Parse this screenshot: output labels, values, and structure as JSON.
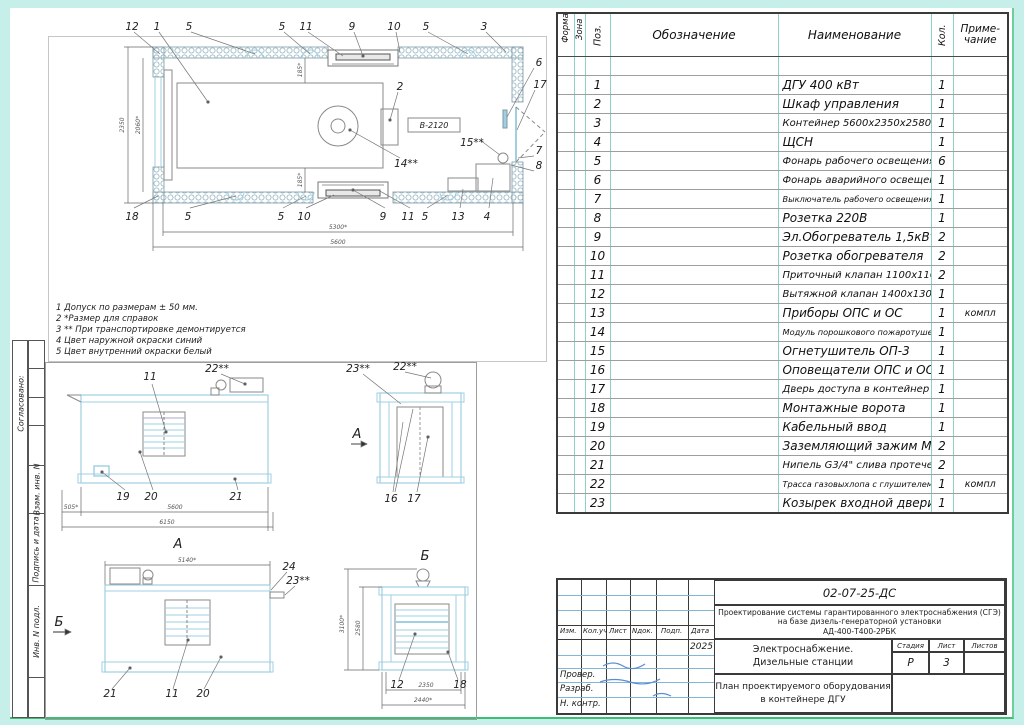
{
  "colors": {
    "sheet_margin": "#c7efe9",
    "drawing_blue": "#9fcfe0",
    "table_teal": "#8fd0c4",
    "signature_blue": "#5b8dd6",
    "frame_green": "#3fbd74"
  },
  "sidebar": {
    "soglasovano": "Согласовано:",
    "vzam": "Взам. инв. N",
    "podpis": "Подпись и дата",
    "inv": "Инв. N подл."
  },
  "notes": [
    "1 Допуск по размерам ± 50 мм.",
    "2 *Размер для справок",
    "3 ** При транспортировке демонтируется",
    "4 Цвет наружной окраски синий",
    "5 Цвет внутренний окраски белый"
  ],
  "spec": {
    "headers": {
      "format": "Формат",
      "zona": "Зона",
      "poz": "Поз.",
      "oboz": "Обозначение",
      "name": "Наименование",
      "kol": "Кол.",
      "prim1": "Приме-",
      "prim2": "чание"
    },
    "rows": [
      {
        "poz": "1",
        "name": "ДГУ 400 кВт",
        "qty": "1",
        "note": ""
      },
      {
        "poz": "2",
        "name": "Шкаф управления",
        "qty": "1",
        "note": ""
      },
      {
        "poz": "3",
        "name": "Контейнер 5600х2350х2580",
        "qty": "1",
        "note": ""
      },
      {
        "poz": "4",
        "name": "ЩСН",
        "qty": "1",
        "note": ""
      },
      {
        "poz": "5",
        "name": "Фонарь рабочего освещения",
        "qty": "6",
        "note": ""
      },
      {
        "poz": "6",
        "name": "Фонарь аварийного освещения",
        "qty": "1",
        "note": ""
      },
      {
        "poz": "7",
        "name": "Выключатель рабочего освещения",
        "qty": "1",
        "note": ""
      },
      {
        "poz": "8",
        "name": "Розетка 220В",
        "qty": "1",
        "note": ""
      },
      {
        "poz": "9",
        "name": "Эл.Обогреватель 1,5кВт",
        "qty": "2",
        "note": ""
      },
      {
        "poz": "10",
        "name": "Розетка обогревателя",
        "qty": "2",
        "note": ""
      },
      {
        "poz": "11",
        "name": "Приточный клапан 1100х1100",
        "qty": "2",
        "note": ""
      },
      {
        "poz": "12",
        "name": "Вытяжной клапан 1400х1300",
        "qty": "1",
        "note": ""
      },
      {
        "poz": "13",
        "name": "Приборы ОПС и ОС",
        "qty": "1",
        "note": "компл"
      },
      {
        "poz": "14",
        "name": "Модуль порошкового пожаротушения",
        "qty": "1",
        "note": ""
      },
      {
        "poz": "15",
        "name": "Огнетушитель ОП-3",
        "qty": "1",
        "note": ""
      },
      {
        "poz": "16",
        "name": "Оповещатели ОПС и ОС",
        "qty": "1",
        "note": ""
      },
      {
        "poz": "17",
        "name": "Дверь доступа в контейнер",
        "qty": "1",
        "note": ""
      },
      {
        "poz": "18",
        "name": "Монтажные ворота",
        "qty": "1",
        "note": ""
      },
      {
        "poz": "19",
        "name": "Кабельный ввод",
        "qty": "1",
        "note": ""
      },
      {
        "poz": "20",
        "name": "Заземляющий зажим М16",
        "qty": "2",
        "note": ""
      },
      {
        "poz": "21",
        "name": "Нипель G3/4\" слива протечек",
        "qty": "2",
        "note": ""
      },
      {
        "poz": "22",
        "name": "Трасса газовыхлопа с глушителем",
        "qty": "1",
        "note": "компл"
      },
      {
        "poz": "23",
        "name": "Козырек входной двери",
        "qty": "1",
        "note": ""
      }
    ]
  },
  "title_block": {
    "doc_number": "02-07-25-ДС",
    "desc1": "Проектирование системы гарантированного электроснабжения (СГЭ)",
    "desc2": "на базе дизель-генераторной установки",
    "desc3": "АД-400-Т400-2РБК",
    "cols": [
      "Изм.",
      "Кол.уч",
      "Лист",
      "Nдок.",
      "Подп.",
      "Дата"
    ],
    "date": "2025",
    "roles": [
      "Провер.",
      "Разраб.",
      "Н. контр."
    ],
    "section1": "Электроснабжение.",
    "section2": "Дизельные станции",
    "stage_label": "Стадия",
    "sheet_label": "Лист",
    "sheets_label": "Листов",
    "stage": "Р",
    "sheet": "3",
    "sheets": "",
    "plan1": "План проектируемого оборудования",
    "plan2": "в контейнере ДГУ"
  },
  "plan": {
    "top": [
      "12",
      "1",
      "5",
      "5",
      "11",
      "9",
      "10",
      "5",
      "3"
    ],
    "bottom": [
      "18",
      "5",
      "5",
      "10",
      "9",
      "11",
      "5",
      "13",
      "4"
    ],
    "right": [
      "6",
      "17",
      "7",
      "8"
    ],
    "inner": {
      "item2": "2",
      "b2120": "В-2120",
      "item14": "14**",
      "item15": "15**"
    },
    "dims": {
      "h_outer": "2350",
      "h_inner": "2060*",
      "off_top": "185*",
      "off_bot": "185*",
      "w_inner": "5300*",
      "w_outer": "5600"
    }
  },
  "side": {
    "c11": "11",
    "c22": "22**",
    "c19": "19",
    "c20": "20",
    "c21": "21",
    "d505": "505*",
    "d5600": "5600",
    "d6150": "6150"
  },
  "endv": {
    "view": "А",
    "c23": "23**",
    "c22": "22**",
    "c16": "16",
    "c17": "17"
  },
  "view_a": {
    "title": "А",
    "dim": "5140*",
    "c24": "24",
    "c23": "23**",
    "view": "Б",
    "c21": "21",
    "c11": "11",
    "c20": "20"
  },
  "view_b": {
    "title": "Б",
    "d_out": "3100*",
    "d_in": "2580",
    "d2350": "2350",
    "d2440": "2440*",
    "c12": "12",
    "c18": "18"
  }
}
